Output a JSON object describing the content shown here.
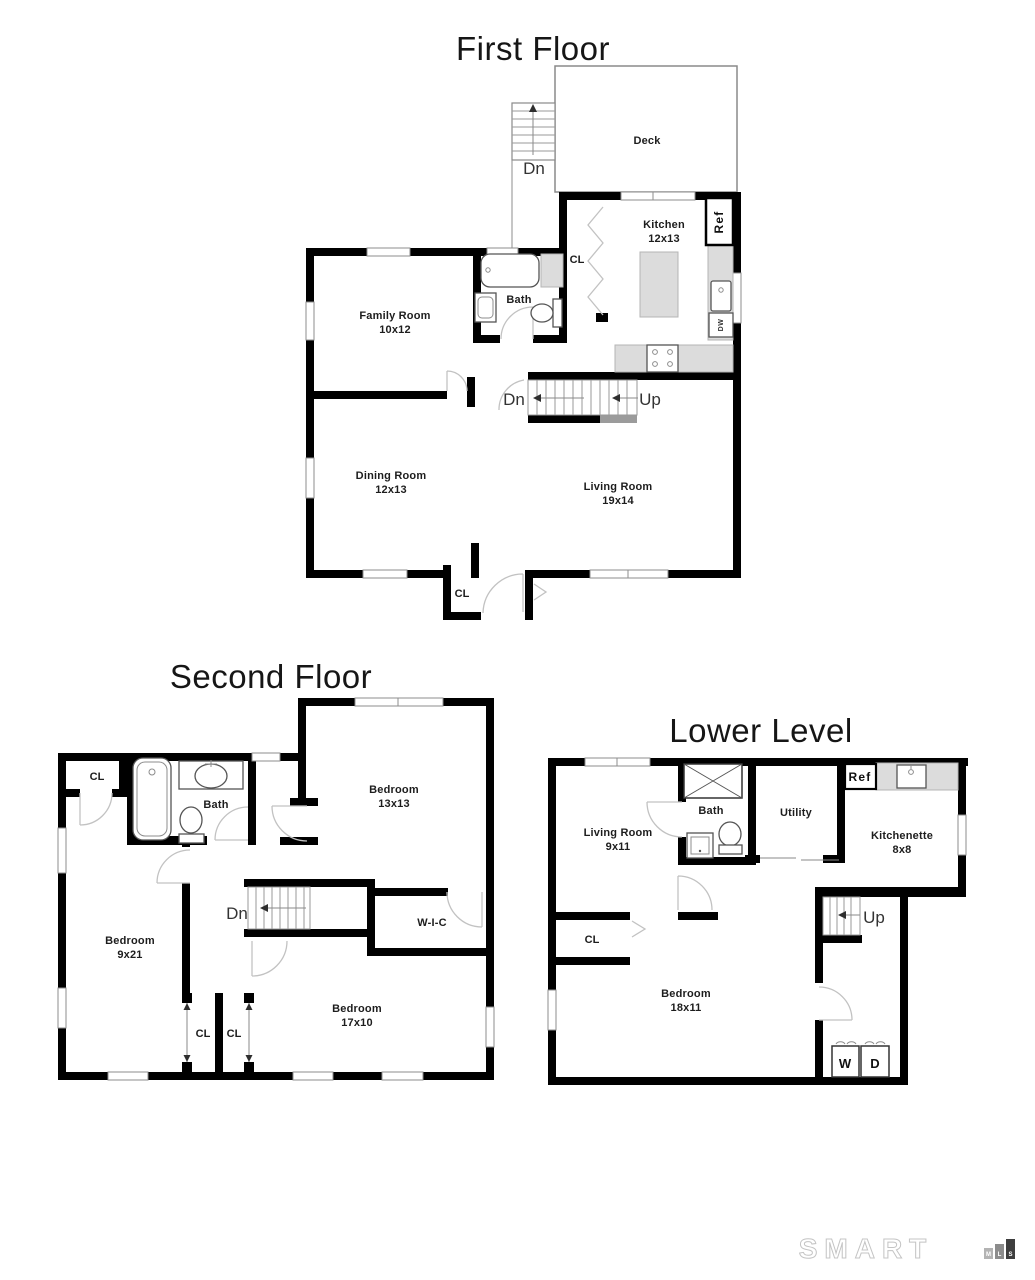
{
  "floors": [
    {
      "title": "First Floor",
      "rooms": {
        "deck": {
          "name": "Deck"
        },
        "kitchen": {
          "name": "Kitchen",
          "dims": "12x13"
        },
        "family_room": {
          "name": "Family Room",
          "dims": "10x12"
        },
        "bath": {
          "name": "Bath"
        },
        "dining_room": {
          "name": "Dining Room",
          "dims": "12x13"
        },
        "living_room": {
          "name": "Living Room",
          "dims": "19x14"
        }
      },
      "labels": {
        "deck_stairs": "Dn",
        "stairs_down": "Dn",
        "stairs_up": "Up",
        "kitchen_closet": "CL",
        "entry_closet": "CL",
        "refrigerator": "Ref",
        "dishwasher": "DW"
      }
    },
    {
      "title": "Second Floor",
      "rooms": {
        "bedroom_1": {
          "name": "Bedroom",
          "dims": "13x13"
        },
        "bath": {
          "name": "Bath"
        },
        "bedroom_2": {
          "name": "Bedroom",
          "dims": "9x21"
        },
        "bedroom_3": {
          "name": "Bedroom",
          "dims": "17x10"
        },
        "walk_in_closet": {
          "name": "W-I-C"
        }
      },
      "labels": {
        "hall_closet": "CL",
        "closet_left": "CL",
        "closet_right": "CL",
        "stairs_down": "Dn"
      }
    },
    {
      "title": "Lower Level",
      "rooms": {
        "living_room": {
          "name": "Living Room",
          "dims": "9x11"
        },
        "bath": {
          "name": "Bath"
        },
        "utility": {
          "name": "Utility"
        },
        "kitchenette": {
          "name": "Kitchenette",
          "dims": "8x8"
        },
        "bedroom": {
          "name": "Bedroom",
          "dims": "18x11"
        }
      },
      "labels": {
        "refrigerator": "Ref",
        "stairs_up": "Up",
        "closet": "CL",
        "washer": "W",
        "dryer": "D"
      }
    }
  ],
  "branding": {
    "name": "SMART",
    "mls": [
      "M",
      "L",
      "S"
    ]
  }
}
